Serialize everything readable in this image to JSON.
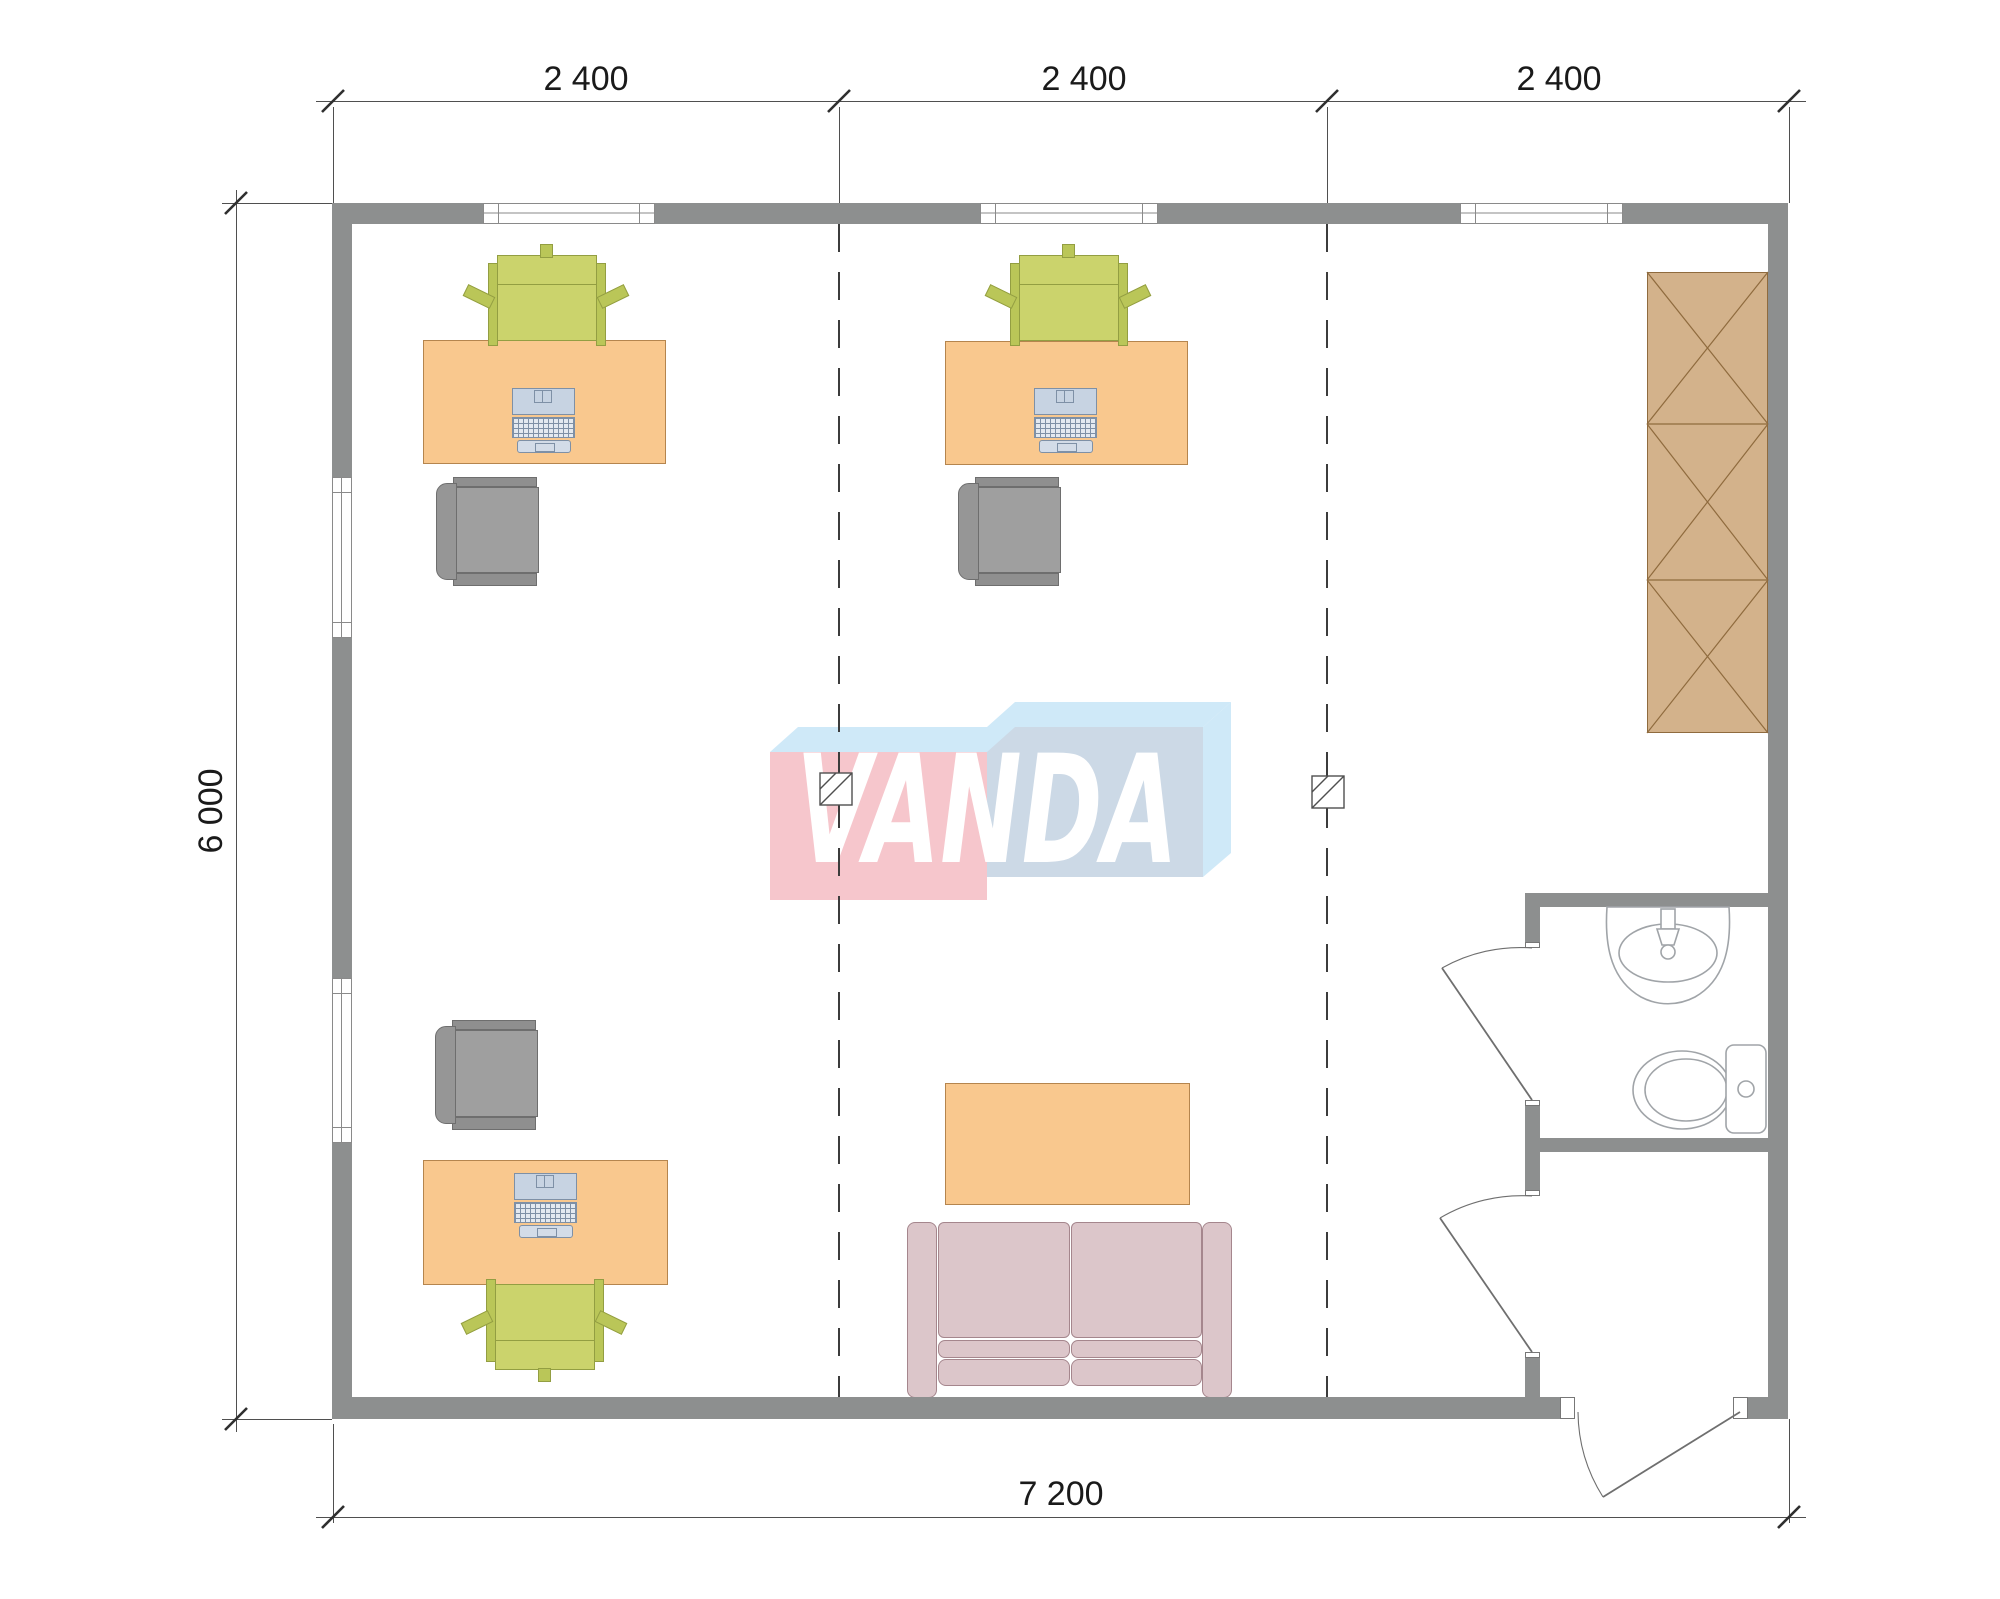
{
  "plan": {
    "watermark_text": "VANDA",
    "dimensions": {
      "top": [
        {
          "label": "2 400"
        },
        {
          "label": "2 400"
        },
        {
          "label": "2 400"
        }
      ],
      "left": {
        "label": "6 000"
      },
      "bottom": {
        "label": "7 200"
      }
    },
    "symbols": {
      "desk": "orange work desk with laptop",
      "office-chair": "green task chair",
      "side-chair": "gray visitor chair",
      "sofa": "two-seat sofa",
      "coffee-table": "orange low table",
      "wardrobe": "tall cabinet with X door panels",
      "sink": "washbasin outline",
      "toilet": "WC outline",
      "door": "quarter-circle swing",
      "axis": "dashed module line",
      "hatch": "diagonal hatched square marker"
    }
  },
  "colors": {
    "wall": "#8d8f8f",
    "window-line": "#8a8a8a",
    "desk": "#f9c88e",
    "desk-border": "#b5854e",
    "chair-green": "#cbd36c",
    "chair-green-dark": "#bac658",
    "chair-green-border": "#939e42",
    "chair-gray": "#9f9f9f",
    "chair-gray-dark": "#8f8f8f",
    "chair-gray-back": "#969696",
    "chair-gray-border": "#6e6e6e",
    "laptop": "#c7d3e2",
    "laptop-kb": "#e3e9f0",
    "laptop-tray": "#d3dce8",
    "laptop-border": "#7e90a6",
    "cabinet": "#d3b28b",
    "cabinet-line": "#8f6b3e",
    "sofa": "#dcc6ca",
    "sofa-border": "#a5868d",
    "logo-pink": "#f6c6cc",
    "logo-blue-top": "#cfe9f8",
    "logo-blue-front": "#ccd9e6",
    "dim-line": "#4f4f4f",
    "dim-text": "#1a1a1a",
    "dash-line": "#3c3c3c",
    "fixture-line": "#a0a4a8",
    "door-line": "#6f6f6f"
  }
}
